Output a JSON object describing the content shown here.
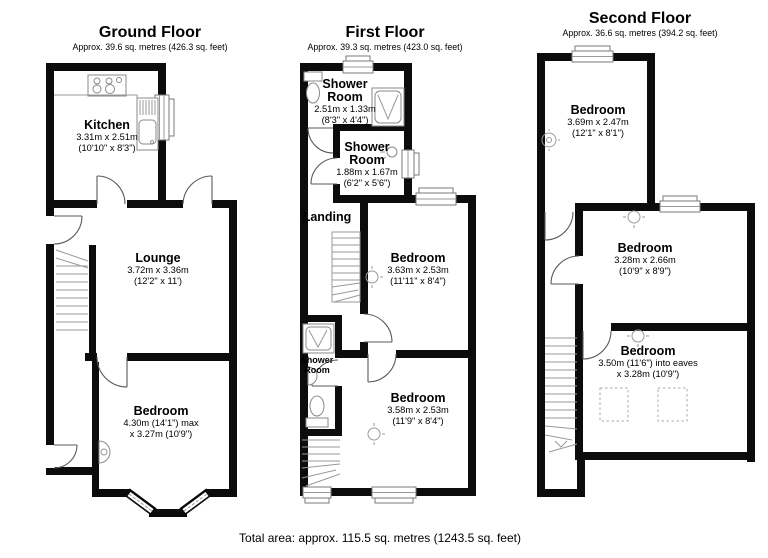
{
  "style": {
    "wall_color": "#0c0c0c"
  },
  "footer": {
    "total_area": "Total area: approx. 115.5 sq. metres (1243.5 sq. feet)"
  },
  "floors": {
    "ground": {
      "title": "Ground Floor",
      "subtitle": "Approx. 39.6 sq. metres (426.3 sq. feet)",
      "rooms": {
        "kitchen": {
          "name": "Kitchen",
          "dims_m": "3.31m x 2.51m",
          "dims_ft": "(10'10\" x 8'3\")"
        },
        "lounge": {
          "name": "Lounge",
          "dims_m": "3.72m x 3.36m",
          "dims_ft": "(12'2\" x 11')"
        },
        "bedroom": {
          "name": "Bedroom",
          "dims_m": "4.30m (14'1\") max",
          "dims_ft": "x 3.27m (10'9\")"
        }
      }
    },
    "first": {
      "title": "First Floor",
      "subtitle": "Approx. 39.3 sq. metres (423.0 sq. feet)",
      "rooms": {
        "shower1": {
          "name": "Shower Room",
          "dims_m": "2.51m x 1.33m",
          "dims_ft": "(8'3\" x 4'4\")"
        },
        "shower2": {
          "name": "Shower Room",
          "dims_m": "1.88m x 1.67m",
          "dims_ft": "(6'2\" x 5'6\")"
        },
        "landing": {
          "name": "Landing"
        },
        "bedroom1": {
          "name": "Bedroom",
          "dims_m": "3.63m x 2.53m",
          "dims_ft": "(11'11\" x 8'4\")"
        },
        "shower3": {
          "name": "Shower Room"
        },
        "bedroom2": {
          "name": "Bedroom",
          "dims_m": "3.58m x 2.53m",
          "dims_ft": "(11'9\" x 8'4\")"
        }
      }
    },
    "second": {
      "title": "Second Floor",
      "subtitle": "Approx. 36.6 sq. metres (394.2 sq. feet)",
      "rooms": {
        "bedroom_top": {
          "name": "Bedroom",
          "dims_m": "3.69m x 2.47m",
          "dims_ft": "(12'1\" x 8'1\")"
        },
        "bedroom_mid": {
          "name": "Bedroom",
          "dims_m": "3.28m x 2.66m",
          "dims_ft": "(10'9\" x 8'9\")"
        },
        "bedroom_bottom": {
          "name": "Bedroom",
          "dims_m": "3.50m (11'6\") into eaves",
          "dims_ft": "x 3.28m (10'9\")"
        }
      }
    }
  }
}
